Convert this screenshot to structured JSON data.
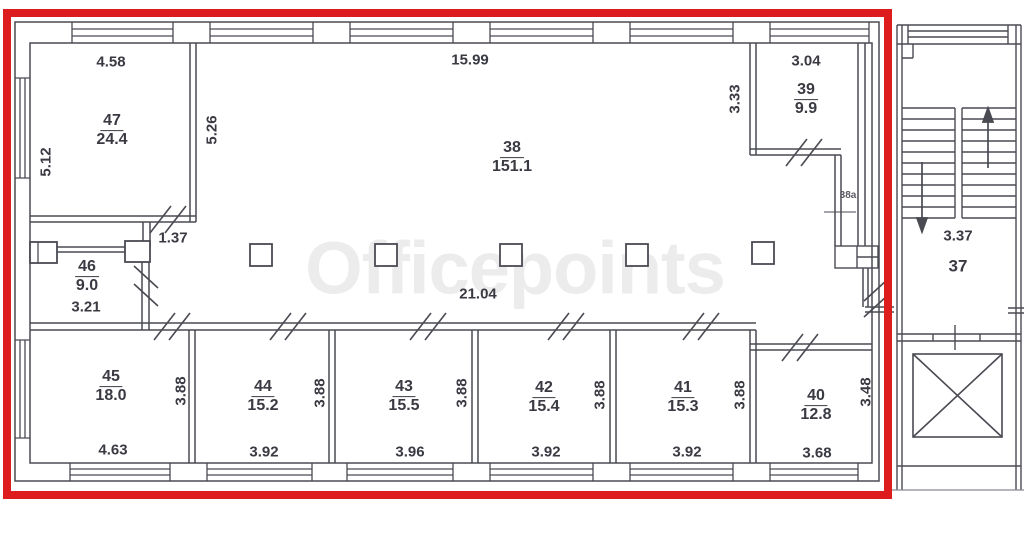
{
  "watermark": "Officepoints",
  "colors": {
    "highlight": "#dd1d1d",
    "line": "#4a4a53",
    "text": "#3a3a43",
    "watermark": "#ececec"
  },
  "rooms": {
    "r47": {
      "number": "47",
      "area": "24.4"
    },
    "r38": {
      "number": "38",
      "area": "151.1"
    },
    "r39": {
      "number": "39",
      "area": "9.9"
    },
    "r46": {
      "number": "46",
      "area": "9.0"
    },
    "r45": {
      "number": "45",
      "area": "18.0"
    },
    "r44": {
      "number": "44",
      "area": "15.2"
    },
    "r43": {
      "number": "43",
      "area": "15.5"
    },
    "r42": {
      "number": "42",
      "area": "15.4"
    },
    "r41": {
      "number": "41",
      "area": "15.3"
    },
    "r40": {
      "number": "40",
      "area": "12.8"
    },
    "r38a": {
      "number": "38a"
    },
    "r37": {
      "number": "37"
    }
  },
  "dims": {
    "d47_top": "4.58",
    "d47_left": "5.12",
    "d47_right": "5.26",
    "d38_top": "15.99",
    "d38_bottom": "21.04",
    "d39_top": "3.04",
    "d39_left": "3.33",
    "d46_door": "1.37",
    "d46_bottom": "3.21",
    "d45_bottom": "4.63",
    "d45_right": "3.88",
    "d44_bottom": "3.92",
    "d44_right": "3.88",
    "d43_bottom": "3.96",
    "d43_right": "3.88",
    "d42_bottom": "3.92",
    "d42_right": "3.88",
    "d41_bottom": "3.92",
    "d41_right": "3.88",
    "d40_bottom": "3.68",
    "d40_right": "3.48",
    "d37_stair": "3.37"
  }
}
